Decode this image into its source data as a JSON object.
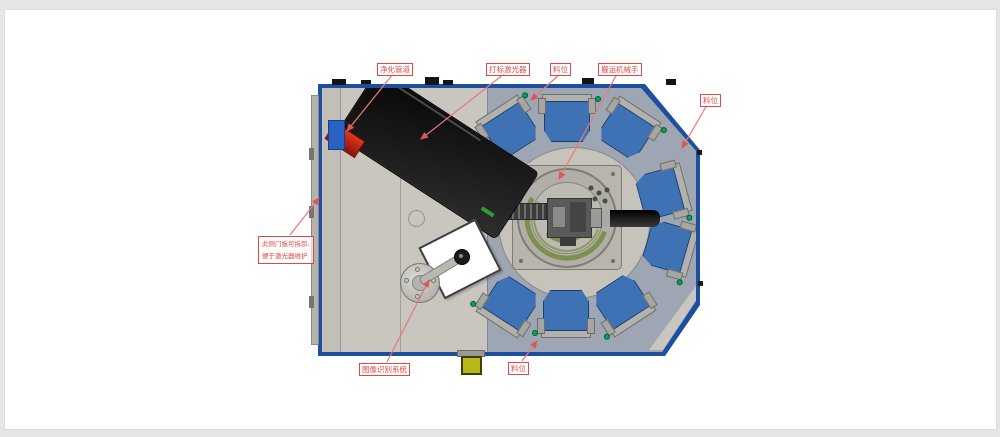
{
  "diagram": {
    "labels": {
      "purification_pipe": "净化管道",
      "marking_laser": "打标激光器",
      "station_top": "料位",
      "handling_robot": "搬运机械手",
      "station_right": "料位",
      "door_note_line1": "此侧门板可拆卸,",
      "door_note_line2": "便于激光器维护",
      "vision_system": "图像识别系统",
      "station_bottom": "料位"
    },
    "colors": {
      "annotation_red": "#e04848",
      "frame_blue": "#1d4fa0",
      "tray_blue": "#3f72b4",
      "indicator_green": "#00a651",
      "floor_tan": "#c9c6bf",
      "plate_gray": "#9ea6b4",
      "laser_black": "#141414",
      "pipe_red": "#c01818",
      "sensor_yellow": "#b8b719"
    }
  }
}
